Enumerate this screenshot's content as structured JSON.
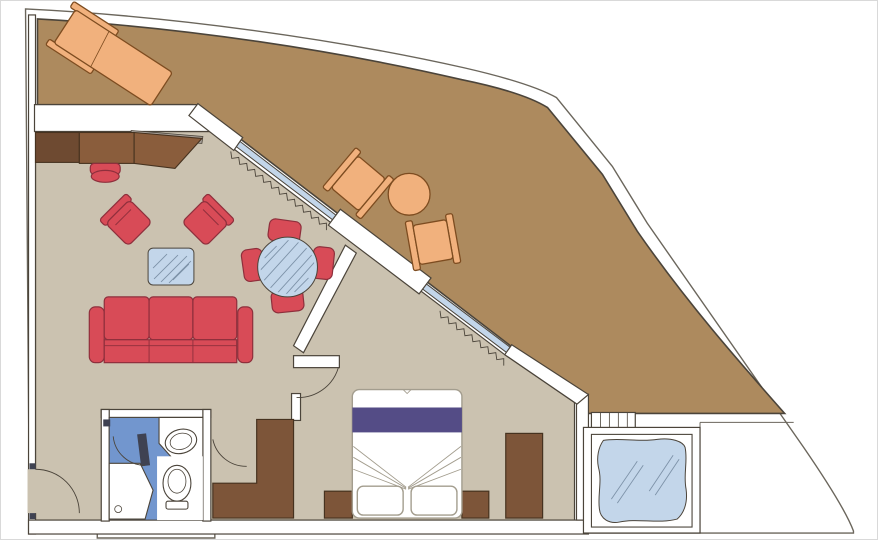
{
  "meta": {
    "type": "floor-plan",
    "subject": "Cruise ship suite floor plan with wrap-around private balcony and whirlpool deck"
  },
  "colors": {
    "paper": "#ffffff",
    "border": "#d9d9d9",
    "outline": "#4b443a",
    "outline_soft": "#6b665c",
    "balcony": "#ad8a5e",
    "floor": "#cbc2b0",
    "wall": "#ffffff",
    "glass": "#c3d6ea",
    "glass_hatch": "#7d92a8",
    "red": "#d84b57",
    "red_dark": "#8e2f3c",
    "wood": "#8a5d3c",
    "wood_dark": "#6e4a31",
    "wood_line": "#46321f",
    "casegood": "#7d5539",
    "shelf": "#a7a099",
    "bath_floor": "#7296ce",
    "bed_line": "#a39d8e",
    "bed_band": "#544c86",
    "door_leaf": "#3f4252",
    "outdoor": "#f1b17d",
    "outdoor_line": "#7d4c20"
  },
  "rooms": {
    "balcony": {
      "furniture": [
        "sun-lounger",
        "lounge-chair",
        "lounge-chair",
        "round-table"
      ]
    },
    "living_room": {
      "furniture": [
        "sideboard-desk",
        "stool",
        "armchair",
        "armchair",
        "glass-coffee-table",
        "three-seat-sofa",
        "round-glass-dining-table",
        "dining-chair",
        "dining-chair",
        "dining-chair",
        "dining-chair"
      ]
    },
    "bedroom": {
      "furniture": [
        "double-bed",
        "pillow",
        "pillow",
        "nightstand",
        "nightstand",
        "wardrobe",
        "closet"
      ]
    },
    "bathroom": {
      "fixtures": [
        "shower",
        "toilet",
        "washbasin",
        "bath-door"
      ]
    },
    "whirlpool_deck": {
      "features": [
        "whirlpool-tub",
        "steps"
      ]
    }
  }
}
